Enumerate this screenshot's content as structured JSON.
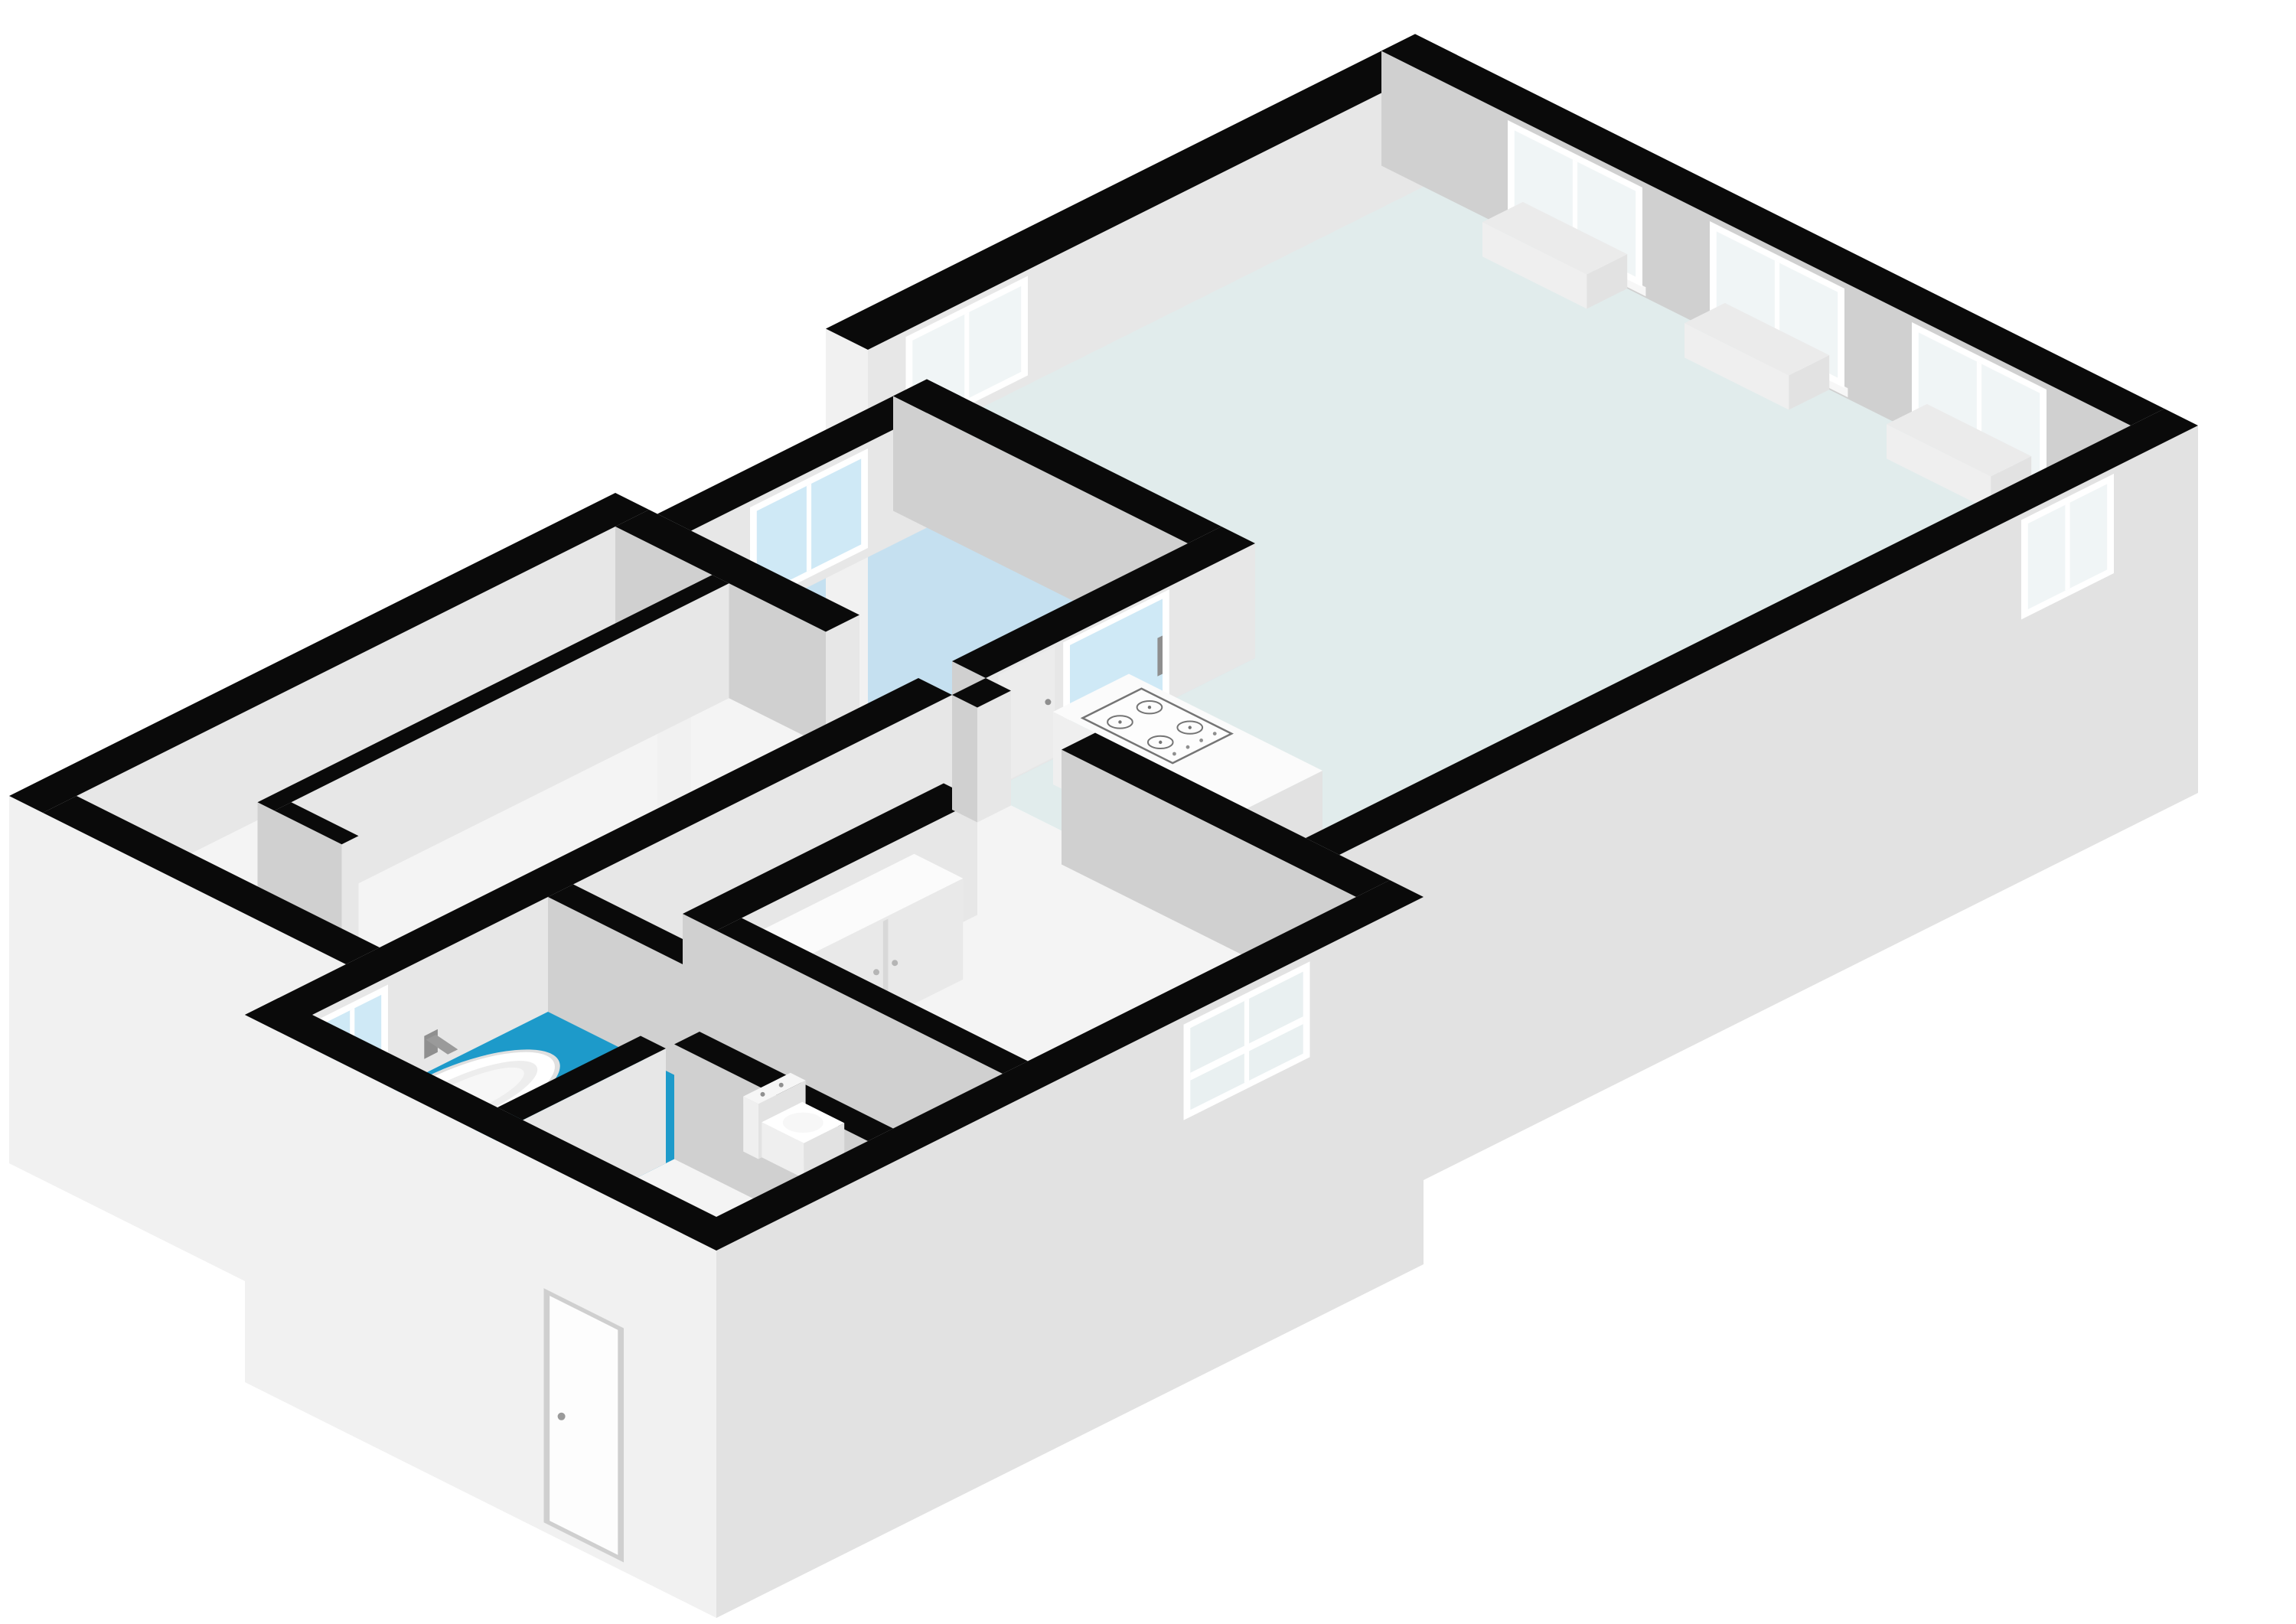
{
  "scene": {
    "kind": "3d-floorplan-render",
    "projection": "isometric",
    "background": "#ffffff",
    "text_labels": []
  },
  "palette": {
    "background": "#ffffff",
    "wall_top": "#0a0a0a",
    "wall_face_light": "#e7e7e7",
    "wall_face_dark": "#d0d0d0",
    "exterior_face_light": "#f1f1f1",
    "exterior_face_shaded": "#e2e2e2",
    "floor_white": "#f4f4f4",
    "floor_hall_blue": "#c5e0f0",
    "floor_living_aqua": "#e1ecec",
    "floor_bathroom_blue": "#1d9aca",
    "window_glass_blue": "#cfe9f6",
    "window_glass_pale": "#f0f5f6",
    "window_glass_soft": "#e9f0f1",
    "window_frame": "#ffffff",
    "fixture_white": "#fbfbfb",
    "fixture_shade_light": "#efefef",
    "fixture_shade_dark": "#e2e2e2",
    "hob_outline": "#757575",
    "radiator_gray": "#ebebeb",
    "door_leaf_gray": "#ececec",
    "handle_gray": "#8f8f8f",
    "tub_rim_gray": "#e0e0e0",
    "tub_inner_gray": "#ededed",
    "sill_white": "#f7f7f7"
  },
  "building": {
    "rooms": [
      {
        "id": "bedroom",
        "floor": "floor_white"
      },
      {
        "id": "walk-in-closet",
        "floor": "floor_white"
      },
      {
        "id": "entrance-hall",
        "floor": "floor_hall_blue"
      },
      {
        "id": "living-room-kitchen",
        "floor": "floor_living_aqua"
      },
      {
        "id": "corridor",
        "floor": "floor_white"
      },
      {
        "id": "bathroom",
        "floor": "floor_bathroom_blue"
      },
      {
        "id": "wc",
        "floor": "floor_white"
      },
      {
        "id": "entry",
        "floor": "floor_white"
      },
      {
        "id": "bedroom-2",
        "floor": "floor_white"
      }
    ],
    "fixtures": [
      {
        "id": "bathtub",
        "room": "bathroom"
      },
      {
        "id": "bath-tap",
        "room": "bathroom"
      },
      {
        "id": "kitchen-island",
        "room": "living-room-kitchen"
      },
      {
        "id": "gas-hob-icon",
        "room": "living-room-kitchen"
      },
      {
        "id": "toilet",
        "room": "wc"
      },
      {
        "id": "wardrobe",
        "room": "bedroom-2"
      },
      {
        "id": "radiator-1",
        "room": "living-room-kitchen"
      },
      {
        "id": "radiator-2",
        "room": "living-room-kitchen"
      },
      {
        "id": "radiator-3",
        "room": "living-room-kitchen"
      }
    ],
    "windows": [
      {
        "id": "window-hall",
        "wall": "hall-nw"
      },
      {
        "id": "window-living-nw",
        "wall": "living-nw"
      },
      {
        "id": "window-living-ne-1",
        "wall": "living-ne"
      },
      {
        "id": "window-living-ne-2",
        "wall": "living-ne"
      },
      {
        "id": "window-living-ne-3",
        "wall": "living-ne"
      },
      {
        "id": "window-living-se",
        "wall": "living-se"
      },
      {
        "id": "window-bathroom",
        "wall": "lower-nw"
      },
      {
        "id": "window-bedroom2",
        "wall": "lower-se"
      }
    ],
    "doors": [
      {
        "id": "front-door",
        "wall": "lower-sw"
      },
      {
        "id": "sliding-glass-door",
        "wall": "hall-kitchen"
      },
      {
        "id": "interior-door-leaf",
        "wall": "hall-kitchen"
      }
    ]
  }
}
